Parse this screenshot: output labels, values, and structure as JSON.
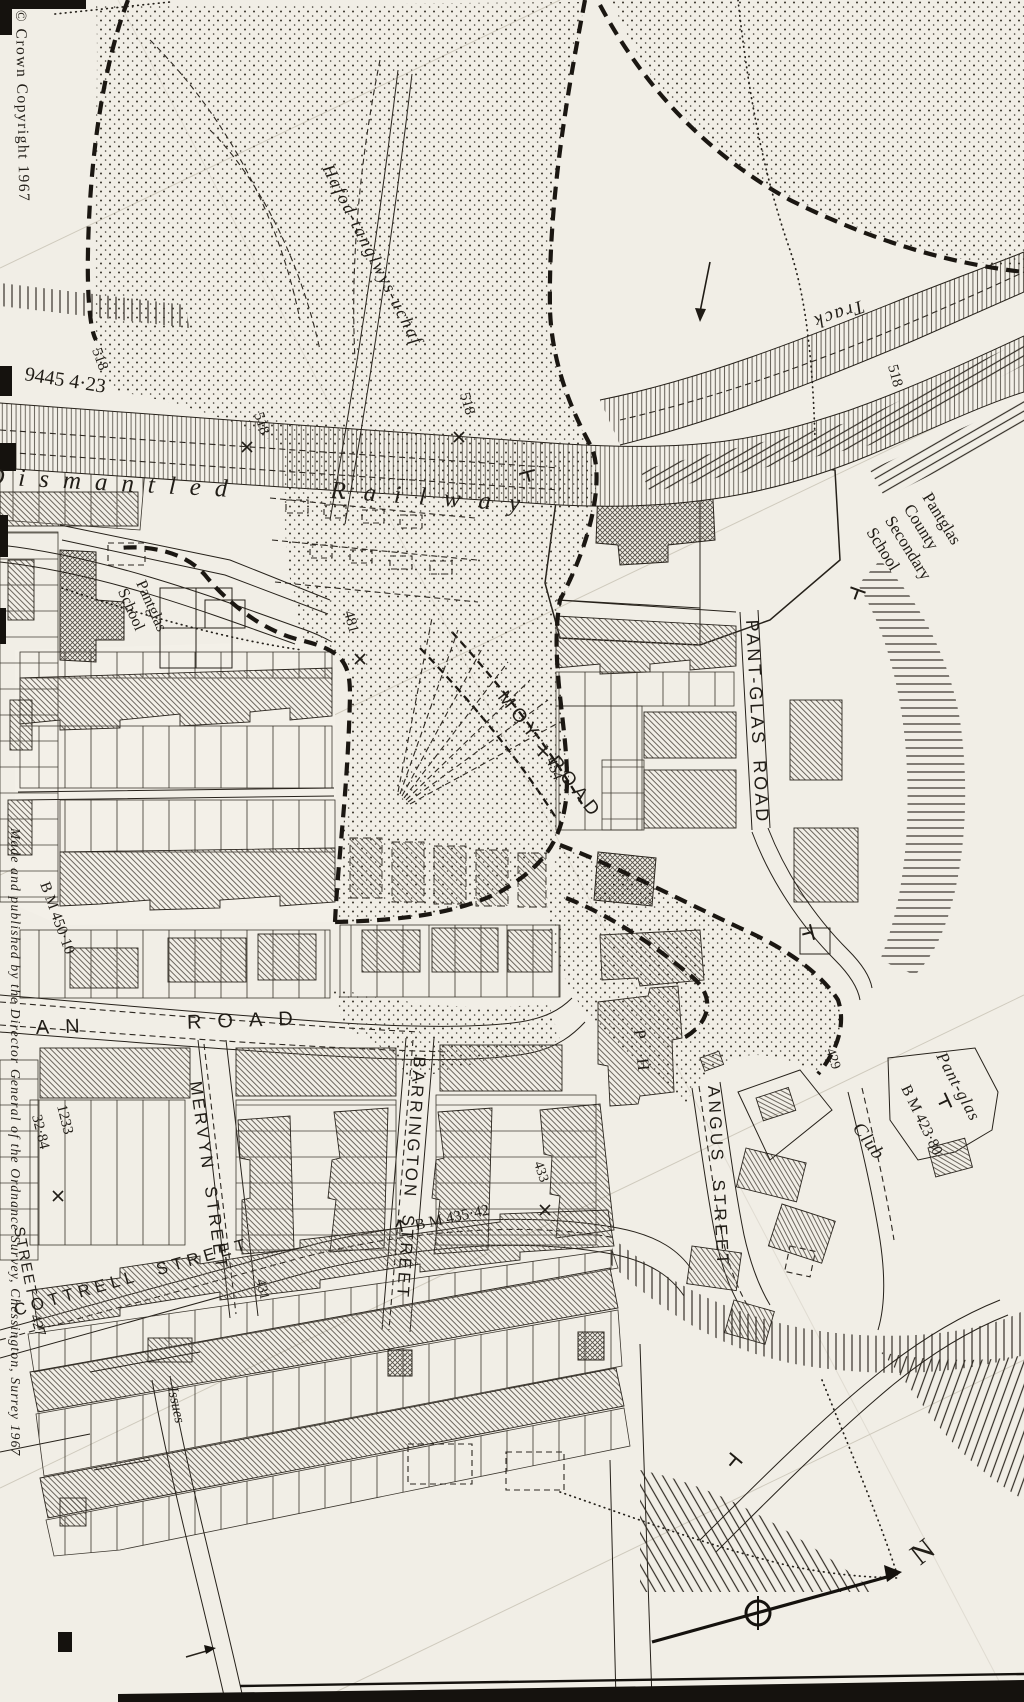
{
  "map": {
    "edge": {
      "copyright": "© Crown Copyright 1967",
      "imprint": "Made and published by the Director General of the Ordnance Survey, Chessington, Surrey 1967"
    },
    "places": {
      "farm": "Hafod-tanglwys-uchaf",
      "railway_w1": "Dismantled",
      "railway_w2": "Railway",
      "track": "Track",
      "senior_school": {
        "l1": "Pantglas",
        "l2": "County",
        "l3": "Secondary",
        "l4": "School"
      },
      "junior_school": {
        "l1": "Pantglas",
        "l2": "School"
      },
      "pub": "P H",
      "club": "Club",
      "house": "Pant-glas",
      "issues": "Issues",
      "north": "N"
    },
    "streets": {
      "moy_road": "MOY ROAD",
      "pant_glas_road": "PANT-GLAS ROAD",
      "aberfan_road": "AN ROAD",
      "mervyn": "MERVYN STREET",
      "barrington": "BARRINGTON STREET",
      "angus": "ANGUS STREET",
      "cottrell": "COTTRELL STREET",
      "street_partial": "STREET"
    },
    "benchmarks": {
      "bm1": "B M 450·10",
      "bm2": "B M 435·42",
      "bm3": "B M 423·80"
    },
    "numbers": {
      "parcel": "9445 4·23",
      "n518": "518",
      "n481": "481",
      "n454": "454",
      "n429": "429",
      "n1233": "1233",
      "n3284": "32·84",
      "n431": "431",
      "n433": "433",
      "n427": "427"
    },
    "colors": {
      "paper": "#f1eee6",
      "ink": "#211d17"
    }
  }
}
